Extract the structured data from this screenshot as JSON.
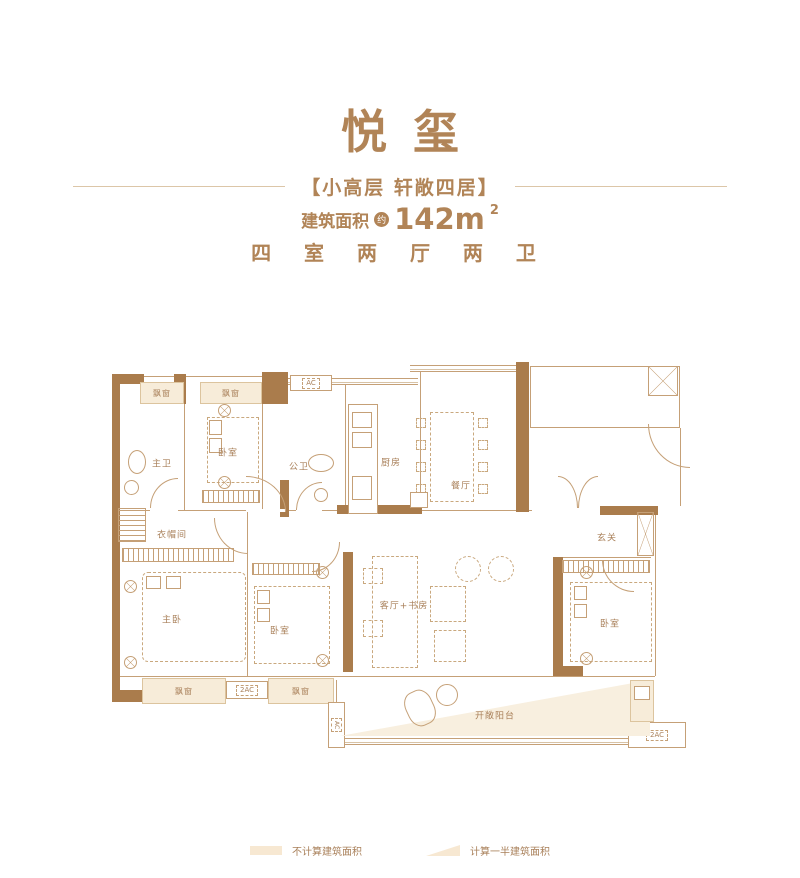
{
  "header": {
    "title": "悦玺",
    "subtitle": "【小高层 轩敞四居】",
    "area_prefix": "建筑面积",
    "area_approx": "约",
    "area_value": "142m",
    "area_sup": "2",
    "config": "四 室 两 厅 两 卫"
  },
  "colors": {
    "accent": "#b18457",
    "wall": "#aa7c4c",
    "line": "#c5a077",
    "bay_fill": "#f7ecd9",
    "shade_fill": "#f8efdf"
  },
  "plan": {
    "rooms": {
      "master_bath": "主卫",
      "bedroom_top": "卧室",
      "public_bath": "公卫",
      "kitchen": "厨房",
      "dining": "餐厅",
      "cloakroom": "衣帽间",
      "foyer": "玄关",
      "master_bedroom": "主卧",
      "bedroom_mid": "卧室",
      "living_study": "客厅+书房",
      "bedroom_right": "卧室",
      "balcony": "开敞阳台"
    },
    "markers": {
      "bay_window": "飘窗",
      "ac": "AC",
      "ac2": "2AC"
    }
  },
  "legend": [
    {
      "label": "不计算建筑面积",
      "swatch": "rect"
    },
    {
      "label": "计算一半建筑面积",
      "swatch": "triangle"
    }
  ]
}
